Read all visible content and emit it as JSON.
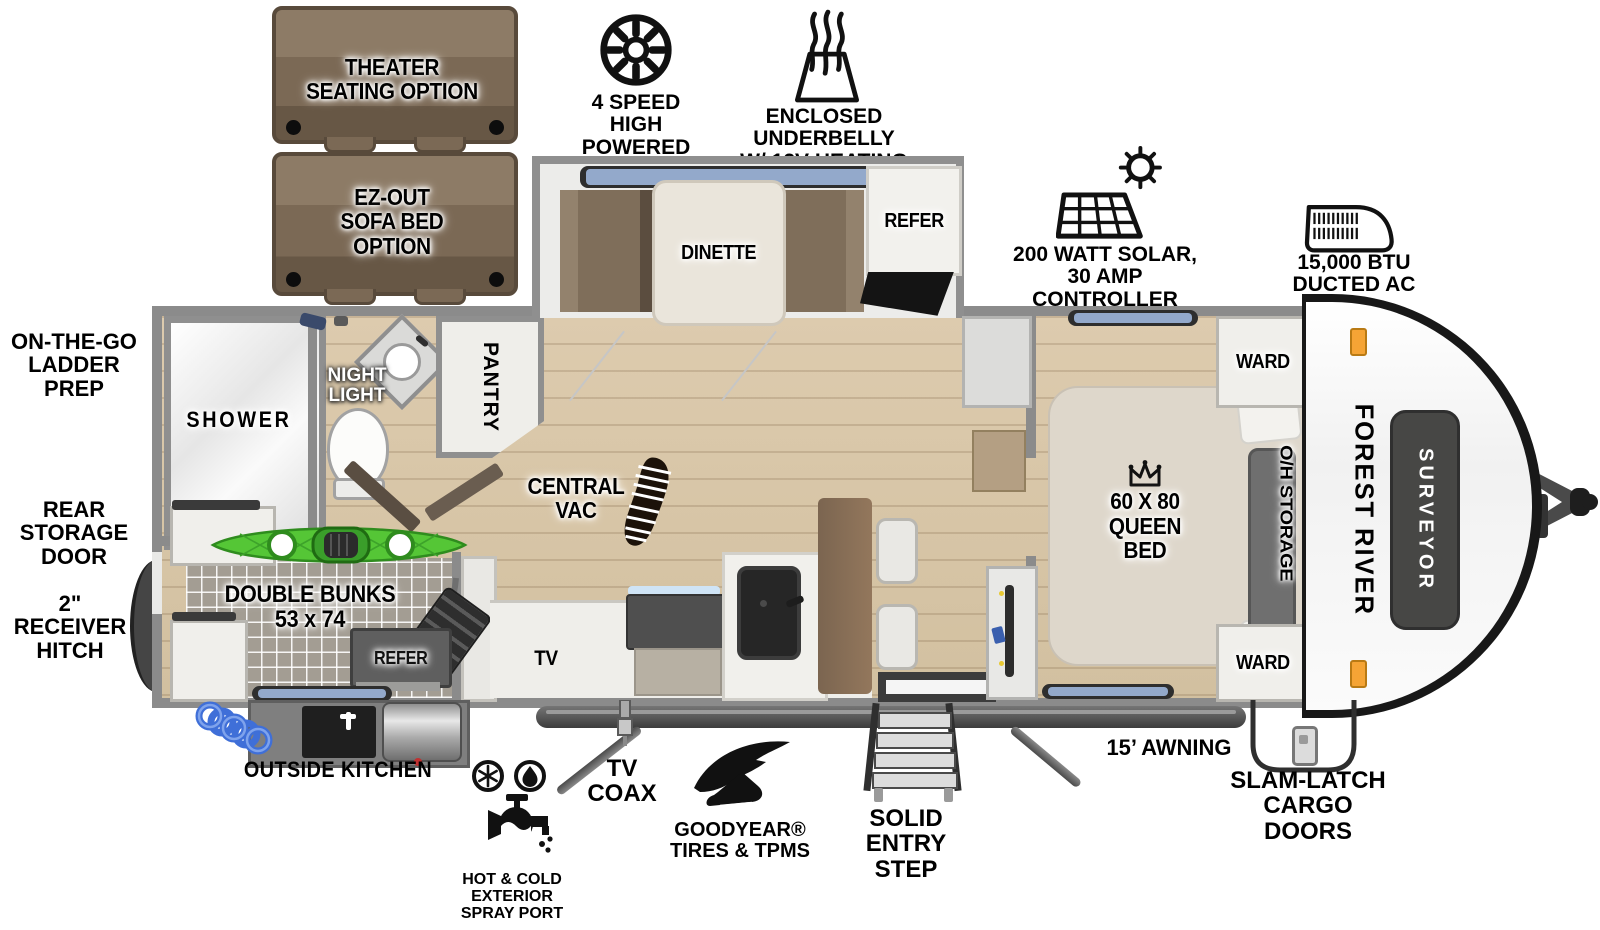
{
  "options": {
    "theater": "THEATER\nSEATING OPTION",
    "sofa_bed": "EZ-OUT\nSOFA BED\nOPTION"
  },
  "callouts": {
    "bath_fan": "4 SPEED\nHIGH POWERED\nBATH FAN",
    "underbelly": "ENCLOSED UNDERBELLY\nW/ 12V HEATING PADS",
    "solar": "200 WATT SOLAR,\n30 AMP CONTROLLER\n& INVERTER PREP",
    "ducted_ac": "15,000 BTU\nDUCTED AC",
    "ladder_prep": "ON-THE-GO\nLADDER PREP",
    "rear_storage_door": "REAR STORAGE\nDOOR",
    "receiver_hitch": "2\" RECEIVER\nHITCH",
    "outside_kitchen": "OUTSIDE KITCHEN",
    "spray_port": "HOT & COLD EXTERIOR\nSPRAY PORT",
    "tv_coax": "TV\nCOAX",
    "goodyear": "GOODYEAR®\nTIRES & TPMS",
    "entry_step": "SOLID ENTRY\nSTEP",
    "awning": "15’ AWNING",
    "cargo_doors": "SLAM-LATCH\nCARGO DOORS"
  },
  "rooms": {
    "dinette": "DINETTE",
    "refer": "REFER",
    "ward_front": "WARD",
    "ward_rear": "WARD",
    "oh_storage": "O/H STORAGE",
    "queen_bed": "60 X 80\nQUEEN BED",
    "shower": "SHOWER",
    "night_light": "NIGHT\nLIGHT",
    "pantry": "PANTRY",
    "central_vac": "CENTRAL\nVAC",
    "double_bunks": "DOUBLE BUNKS\n53 x 74",
    "bunk_refer": "REFER",
    "tv": "TV"
  },
  "branding": {
    "manufacturer": "FOREST RIVER",
    "model": "SURVEYOR"
  },
  "colors": {
    "wood_floor": "#d8c6a8",
    "wall_gray": "#8b8b8b",
    "sofa_brown": "#7b6955",
    "kayak_green": "#55c636",
    "marker_light_orange": "#f5a435",
    "window_blue": "#93a9cb"
  }
}
